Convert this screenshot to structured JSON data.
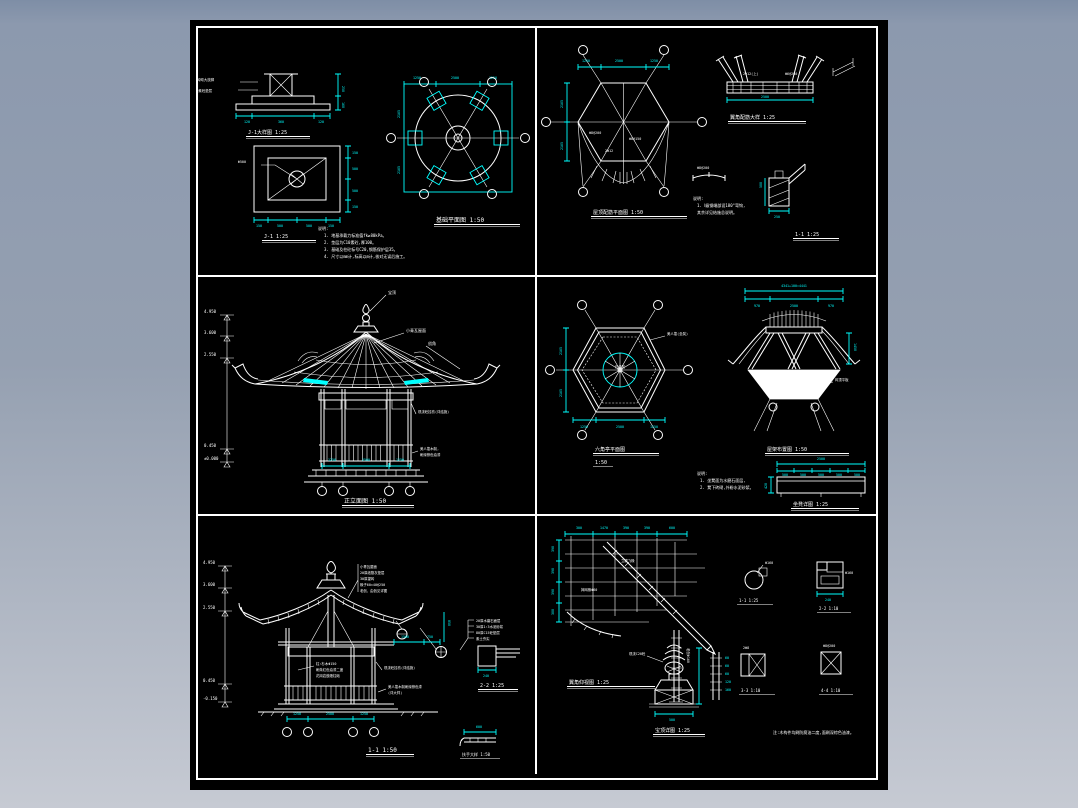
{
  "scene": {
    "bg_top": "#8c99ae",
    "bg_bottom": "#c6cad3",
    "sheet_bg": "#000000",
    "line_color": "#ffffff",
    "accent_color": "#00ffff"
  },
  "p1": {
    "det1_title": "J-1大样图 1:25",
    "det1_labels": [
      "砖砌大放脚",
      "C10素砼垫层"
    ],
    "det1_dims": [
      "120",
      "360",
      "120"
    ],
    "det1_dims_v": [
      "250",
      "160"
    ],
    "det2_title": "J-1 1:25",
    "det2_label": "Φ500",
    "det2_dims_right": [
      "150",
      "500",
      "500",
      "150"
    ],
    "det2_dims_bottom": [
      "150",
      "500",
      "500",
      "150"
    ],
    "plan_title": "基础平面图 1:50",
    "dims_top": [
      "1250",
      "2500",
      "1250"
    ],
    "dims_left": [
      "2165",
      "2165"
    ],
    "notes_title": "说明:",
    "notes": [
      "1. 地基承载力标准值fk≥80kPa。",
      "2. 垫层为C10素砼,厚100。",
      "3. 基础及柱砼标号C20,钢筋保护层35。",
      "4. 尺寸以mm计,标高以m计,核对无误后施工。"
    ]
  },
  "p2": {
    "plan_title": "屋顶配筋平面图 1:50",
    "dims_top": [
      "1250",
      "2500",
      "1250"
    ],
    "dims_left": [
      "2165",
      "2165"
    ],
    "bar_labels": [
      "Φ8@200",
      "Φ8@150",
      "2Φ12"
    ],
    "beam_title": "翼角配筋大样 1:25",
    "beam_label": "2Φ12(上)",
    "beam_label2": "Φ6@200",
    "beam_dim": "2500",
    "arc_label": "Φ8@200",
    "sec_title": "1-1 1:25",
    "sec_dim": "250",
    "sec_dim_v": "500",
    "notes_title": "说明:",
    "notes": [
      "1. Ⅰ级钢端部设180°弯钩,",
      "其余详见结施总说明。"
    ]
  },
  "p3": {
    "title": "正立面图 1:50",
    "label_finial": "宝顶",
    "label_roof": "小青瓦屋面",
    "label_corner": "戗角",
    "label_beam": "现浇砼挂枋(详结施)",
    "label_rail": [
      "美人靠木制,",
      "刷深棕色油漆"
    ],
    "levels": [
      "4.950",
      "3.600",
      "2.550"
    ],
    "levels_low": [
      "0.450",
      "±0.000"
    ],
    "dims_bottom": [
      "1250",
      "2500",
      "1250"
    ]
  },
  "p4": {
    "plan_title": "六角亭平面图",
    "plan_scale": "1:50",
    "plan_label": "美人靠(坐凳)",
    "center_label": "石桌凳",
    "dims_bottom": [
      "1250",
      "2500",
      "1250"
    ],
    "dims_left": [
      "2165",
      "2165"
    ],
    "roof_title": "屋架布置图 1:50",
    "roof_dim_total": "4341+100=4441",
    "roof_dims": [
      "970",
      "2500",
      "970"
    ],
    "roof_label": "闷顶平板",
    "roof_dim_side": "1450",
    "bench_title": "坐凳详图 1:25",
    "bench_dim_total": "2500",
    "bench_dims": [
      "500",
      "500",
      "500",
      "500",
      "500"
    ],
    "bench_dim_h": "420",
    "notes_title": "说明:",
    "notes": [
      "1. 坐凳面为水磨石面层,",
      "2. 凳下砖砌,外粉水泥砂浆。"
    ]
  },
  "p5": {
    "title": "1-1 1:50",
    "levels": [
      "4.950",
      "3.600",
      "2.550"
    ],
    "levels_low": [
      "0.450",
      "-0.150"
    ],
    "roof_layers": [
      "小青瓦屋面",
      "20厚纸筋灰垫层",
      "30厚望砖",
      "椽子60×40@250",
      "老戗、由戗见详图"
    ],
    "label_col": [
      "柱:杉木Φ150",
      "刷朱红色油漆二度",
      "花岗岩鼓磴柱础"
    ],
    "label_beam": "现浇砼挂枋(详结施)",
    "label_rail": [
      "美人靠木制刷深棕色漆",
      "(详大样)"
    ],
    "dims_bottom": [
      "1250",
      "2500",
      "1250"
    ],
    "dims_eave": [
      "1500",
      "750"
    ],
    "dims_eave_v": "850",
    "det_title": "2-2 1:25",
    "det_layers": [
      "20厚水磨石面层",
      "30厚1:3水泥砂浆",
      "80厚C15砼垫层",
      "素土夯实"
    ],
    "det_dim": "240",
    "small_title": "扶手大样 1:50",
    "small_dim": "600"
  },
  "p6": {
    "title": "翼角仰视图 1:25",
    "dims_top": [
      "300",
      "1470",
      "390",
      "390",
      "600"
    ],
    "dims_left": [
      "390",
      "390",
      "390",
      "300"
    ],
    "label_a": "摔网椽Φ60",
    "label_b": "立脚飞椽",
    "label_pole": "老戗Φ160",
    "s11_title": "1-1 1:25",
    "s11_label": "Φ160",
    "s22_title": "2-2 1:10",
    "s22_label": "Φ160",
    "s22_dim": "240",
    "s33_title": "3-3 1:10",
    "s33_label": "2Φ8",
    "s44_title": "4-4 1:10",
    "s44_label": "Φ8@200",
    "finial_title": "宝顶详图 1:25",
    "finial_label": "现浇C20砼",
    "finial_dim": "500",
    "ladder_dims": [
      "60",
      "60",
      "60",
      "120",
      "160"
    ],
    "note": "注:木构件均刷防腐油二度,面刷深棕色油漆。"
  }
}
